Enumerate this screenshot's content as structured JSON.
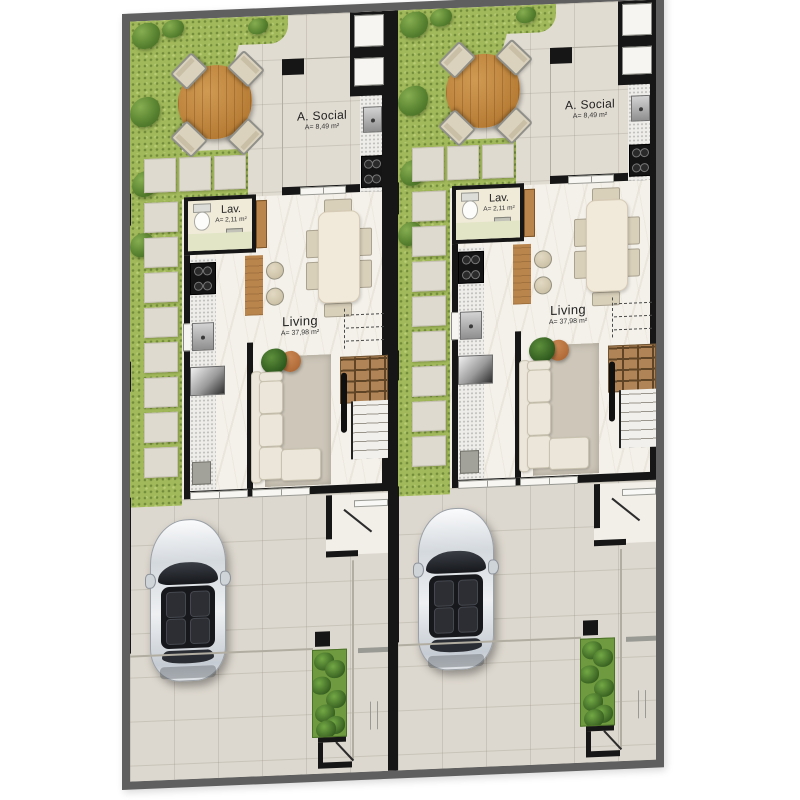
{
  "plan": {
    "kind": "twin-townhouse-ground-floor-plan",
    "units": [
      {
        "name": "unit-1",
        "rooms": {
          "social": {
            "label": "A. Social",
            "area": "A= 8,49 m²"
          },
          "lav": {
            "label": "Lav.",
            "area": "A= 2,11 m²"
          },
          "living": {
            "label": "Living",
            "area": "A= 37,98 m²"
          }
        }
      },
      {
        "name": "unit-2",
        "rooms": {
          "social": {
            "label": "A. Social",
            "area": "A= 8,49 m²"
          },
          "lav": {
            "label": "Lav.",
            "area": "A= 2,11 m²"
          },
          "living": {
            "label": "Living",
            "area": "A= 37,98 m²"
          }
        }
      }
    ],
    "furniture_icons": [
      "round-outdoor-table",
      "outdoor-chair",
      "toilet",
      "washbasin",
      "cooktop",
      "kitchen-sink",
      "refrigerator",
      "breakfast-bar",
      "bar-stool",
      "dining-table",
      "dining-chair",
      "sofa",
      "rug",
      "floor-plant",
      "terracotta-pouf",
      "staircase",
      "stair-railing",
      "car",
      "planter-hedge",
      "door-swing",
      "sliding-door",
      "window",
      "stepping-stone-paver"
    ],
    "colors": {
      "outer_wall": "#5f5f5f",
      "inner_wall": "#161616",
      "terrace_floor": "#e1dcd2",
      "living_floor": "#f4f1ea",
      "grass": "#a2b95b",
      "bush_green": "#557f2e",
      "wood": "#b9854c",
      "table_wood": "#b67c35",
      "sofa_cream": "#ebe6d9",
      "rug_taupe": "#cdc6b9",
      "pouf_terracotta": "#a55f2e",
      "car_silver": "#d4d9de",
      "counter_speckle": "#eeedea"
    }
  }
}
